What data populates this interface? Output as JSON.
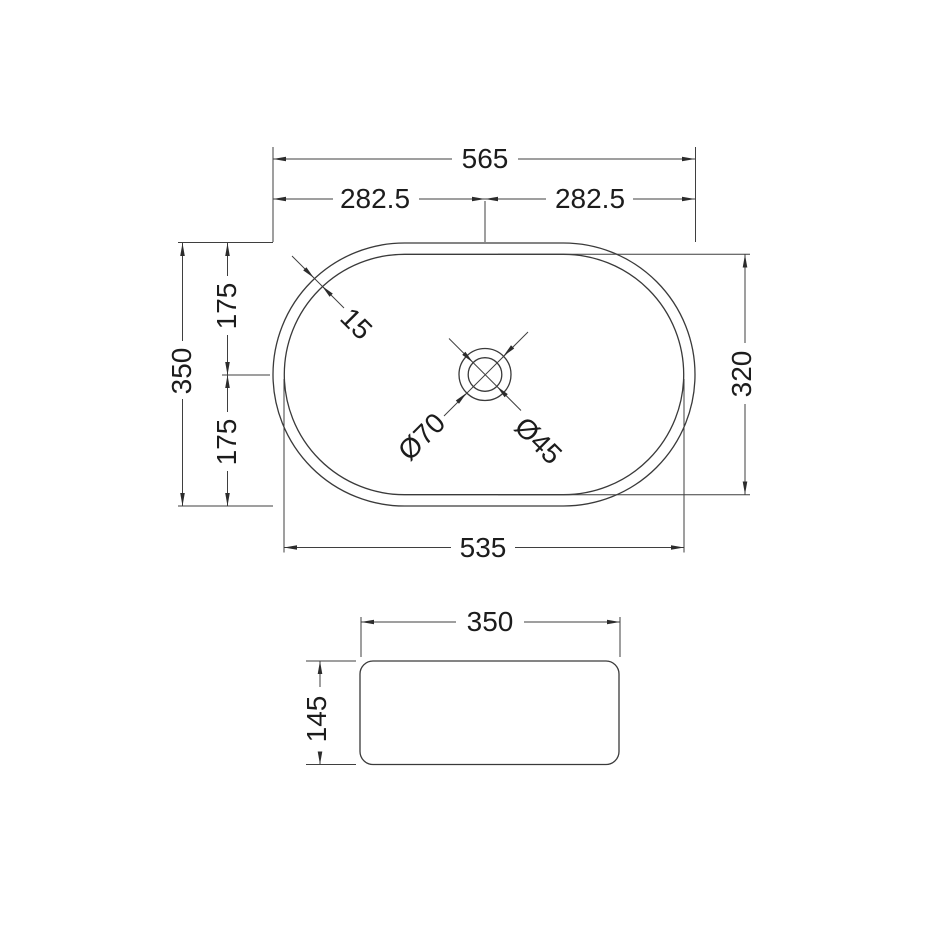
{
  "document": {
    "background_color": "#ffffff",
    "line_color": "#3a3a3a",
    "text_color": "#1c1c1c"
  },
  "top_view": {
    "overall_width": "565",
    "half_width_left": "282.5",
    "half_width_right": "282.5",
    "overall_depth": "350",
    "half_depth_top": "175",
    "half_depth_bottom": "175",
    "inner_width": "535",
    "inner_depth": "320",
    "rim_thickness": "15",
    "drain_outer_diameter": "Ø70",
    "drain_inner_diameter": "Ø45"
  },
  "side_view": {
    "width": "350",
    "height": "145"
  }
}
